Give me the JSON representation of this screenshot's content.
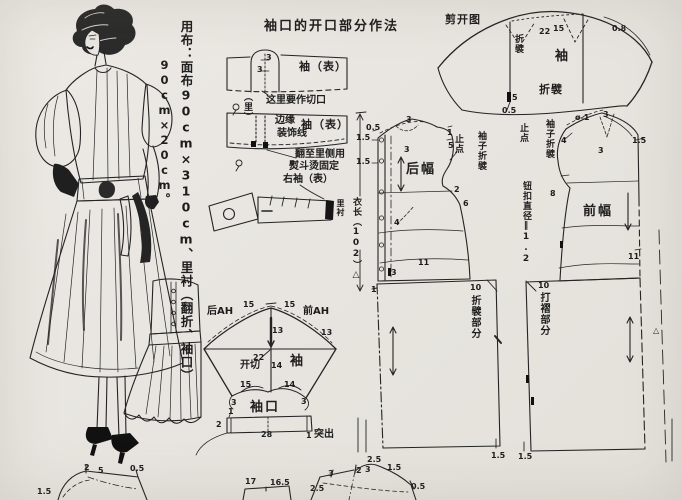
{
  "colors": {
    "paper": "#e9e6e1",
    "ink": "#242424"
  },
  "fabric_note": {
    "column1": "用布：面布90cm×310cm、里衬（翻折、袖口）",
    "column2": "90cm×20cm。"
  },
  "sections": {
    "cuff_howto": [
      {
        "id": "howto-title",
        "text": "袖口的开口部分作法",
        "x": 264,
        "y": 20,
        "cls": "t"
      },
      {
        "id": "slit-3-upper",
        "text": "3",
        "x": 266,
        "y": 54,
        "cls": "s"
      },
      {
        "id": "slit-3-lower",
        "text": "3",
        "x": 257,
        "y": 66,
        "cls": "s"
      },
      {
        "id": "sleeve-outer-label-1",
        "text": "袖（表）",
        "x": 299,
        "y": 61,
        "cls": "b"
      },
      {
        "id": "cut-here-note",
        "text": "这里要作切口",
        "x": 266,
        "y": 96,
        "cls": "m"
      },
      {
        "id": "lining-label-1",
        "text": "（里）",
        "x": 242,
        "y": 92,
        "cls": "s2 v"
      },
      {
        "id": "edge-note-1",
        "text": "边缘",
        "x": 275,
        "y": 116,
        "cls": "m"
      },
      {
        "id": "edge-note-2",
        "text": "装饰线",
        "x": 277,
        "y": 129,
        "cls": "m"
      },
      {
        "id": "sleeve-outer-label-2",
        "text": "袖（表）",
        "x": 301,
        "y": 119,
        "cls": "b"
      },
      {
        "id": "iron-note-1",
        "text": "翻至里侧用",
        "x": 295,
        "y": 150,
        "cls": "m"
      },
      {
        "id": "iron-note-2",
        "text": "熨斗烫固定",
        "x": 289,
        "y": 162,
        "cls": "m"
      },
      {
        "id": "right-sleeve-label",
        "text": "右袖（表）",
        "x": 283,
        "y": 175,
        "cls": "m"
      },
      {
        "id": "lining-label-2",
        "text": "里衬",
        "x": 336,
        "y": 199,
        "cls": "s v"
      }
    ],
    "garment_length": [
      {
        "id": "garment-length-label",
        "text": "衣长（102）△",
        "x": 351,
        "y": 197,
        "cls": "s2 v"
      }
    ],
    "sleeve_draft": [
      {
        "id": "back-ah-label",
        "text": "后AH",
        "x": 207,
        "y": 307,
        "cls": "m"
      },
      {
        "id": "sleeve-15-left",
        "text": "15",
        "x": 243,
        "y": 301,
        "cls": "s"
      },
      {
        "id": "sleeve-15-right",
        "text": "15",
        "x": 284,
        "y": 301,
        "cls": "s"
      },
      {
        "id": "front-ah-label",
        "text": "前AH",
        "x": 303,
        "y": 307,
        "cls": "m"
      },
      {
        "id": "sleeve-13-center",
        "text": "13",
        "x": 272,
        "y": 327,
        "cls": "s"
      },
      {
        "id": "sleeve-13-right",
        "text": "13",
        "x": 321,
        "y": 329,
        "cls": "s"
      },
      {
        "id": "sleeve-22",
        "text": "22",
        "x": 253,
        "y": 354,
        "cls": "s"
      },
      {
        "id": "cut-open-label",
        "text": "开切",
        "x": 240,
        "y": 361,
        "cls": "m"
      },
      {
        "id": "sleeve-14-center",
        "text": "14",
        "x": 271,
        "y": 362,
        "cls": "s"
      },
      {
        "id": "sleeve-label",
        "text": "袖",
        "x": 290,
        "y": 355,
        "cls": "t"
      },
      {
        "id": "sleeve-15-bottom",
        "text": "15",
        "x": 240,
        "y": 381,
        "cls": "s"
      },
      {
        "id": "sleeve-14-bottom",
        "text": "14",
        "x": 284,
        "y": 381,
        "cls": "s"
      },
      {
        "id": "sleeve-3-left",
        "text": "3",
        "x": 231,
        "y": 399,
        "cls": "s"
      },
      {
        "id": "sleeve-3-right",
        "text": "3",
        "x": 301,
        "y": 398,
        "cls": "s"
      },
      {
        "id": "cuff-label",
        "text": "袖口",
        "x": 250,
        "y": 401,
        "cls": "t"
      },
      {
        "id": "cuff-1-left",
        "text": "1",
        "x": 228,
        "y": 408,
        "cls": "s"
      },
      {
        "id": "cuff-2",
        "text": "2",
        "x": 216,
        "y": 421,
        "cls": "s"
      },
      {
        "id": "cuff-28",
        "text": "28",
        "x": 261,
        "y": 431,
        "cls": "s"
      },
      {
        "id": "cuff-1-right",
        "text": "1",
        "x": 306,
        "y": 432,
        "cls": "s"
      },
      {
        "id": "protrude-label",
        "text": "突出",
        "x": 314,
        "y": 430,
        "cls": "m"
      }
    ],
    "spread_diagram": [
      {
        "id": "spread-title",
        "text": "剪开图",
        "x": 445,
        "y": 14,
        "cls": "b"
      },
      {
        "id": "spread-fold-top",
        "text": "折襞",
        "x": 513,
        "y": 34,
        "cls": "s2 v"
      },
      {
        "id": "spread-22",
        "text": "22",
        "x": 539,
        "y": 28,
        "cls": "s"
      },
      {
        "id": "spread-15",
        "text": "15",
        "x": 553,
        "y": 25,
        "cls": "s"
      },
      {
        "id": "spread-08",
        "text": "0.8",
        "x": 612,
        "y": 25,
        "cls": "s"
      },
      {
        "id": "spread-sleeve-label",
        "text": "袖",
        "x": 555,
        "y": 50,
        "cls": "t"
      },
      {
        "id": "spread-fold-bottom",
        "text": "折襞",
        "x": 539,
        "y": 84,
        "cls": "b"
      },
      {
        "id": "spread-5",
        "text": "5",
        "x": 512,
        "y": 94,
        "cls": "s"
      },
      {
        "id": "spread-05",
        "text": "0.5",
        "x": 502,
        "y": 107,
        "cls": "s"
      }
    ],
    "back_panel": [
      {
        "id": "bp-05",
        "text": "0.5",
        "x": 366,
        "y": 124,
        "cls": "s"
      },
      {
        "id": "bp-15-upper",
        "text": "1.5",
        "x": 356,
        "y": 134,
        "cls": "s"
      },
      {
        "id": "bp-15-lower",
        "text": "1.5",
        "x": 356,
        "y": 158,
        "cls": "s"
      },
      {
        "id": "bp-3-shoulder",
        "text": "3",
        "x": 406,
        "y": 116,
        "cls": "s"
      },
      {
        "id": "bp-3-inner",
        "text": "3",
        "x": 404,
        "y": 146,
        "cls": "s"
      },
      {
        "id": "bp-1-neck",
        "text": "1",
        "x": 447,
        "y": 129,
        "cls": "s"
      },
      {
        "id": "bp-5-neck",
        "text": "5",
        "x": 448,
        "y": 142,
        "cls": "s"
      },
      {
        "id": "back-panel-label",
        "text": "后幅",
        "x": 406,
        "y": 163,
        "cls": "t"
      },
      {
        "id": "bp-stop-point",
        "text": "止点",
        "x": 453,
        "y": 134,
        "cls": "s2 v"
      },
      {
        "id": "bp-sleeve-pleat",
        "text": "袖子折襞",
        "x": 476,
        "y": 131,
        "cls": "s2 v"
      },
      {
        "id": "bp-2",
        "text": "2",
        "x": 454,
        "y": 186,
        "cls": "s"
      },
      {
        "id": "bp-6",
        "text": "6",
        "x": 463,
        "y": 200,
        "cls": "s"
      },
      {
        "id": "bp-4",
        "text": "4",
        "x": 394,
        "y": 219,
        "cls": "s"
      },
      {
        "id": "bp-11",
        "text": "11",
        "x": 418,
        "y": 259,
        "cls": "s"
      },
      {
        "id": "bp-3-waist",
        "text": "3",
        "x": 391,
        "y": 269,
        "cls": "s"
      }
    ],
    "front_panel": [
      {
        "id": "fp-stop-point",
        "text": "止点",
        "x": 518,
        "y": 123,
        "cls": "s2 v"
      },
      {
        "id": "fp-sleeve-pleat",
        "text": "袖子折襞",
        "x": 544,
        "y": 119,
        "cls": "s2 v"
      },
      {
        "id": "fp-button-diameter",
        "text": "钮扣直径‖1.2",
        "x": 521,
        "y": 181,
        "cls": "s2 v"
      },
      {
        "id": "fp-d1",
        "text": "ø-1",
        "x": 575,
        "y": 114,
        "cls": "s"
      },
      {
        "id": "fp-3-top",
        "text": "3",
        "x": 603,
        "y": 111,
        "cls": "s"
      },
      {
        "id": "fp-4",
        "text": "4",
        "x": 561,
        "y": 137,
        "cls": "s"
      },
      {
        "id": "fp-3-neck",
        "text": "3",
        "x": 598,
        "y": 147,
        "cls": "s"
      },
      {
        "id": "fp-15",
        "text": "1.5",
        "x": 632,
        "y": 137,
        "cls": "s"
      },
      {
        "id": "fp-8",
        "text": "8",
        "x": 550,
        "y": 190,
        "cls": "s"
      },
      {
        "id": "front-panel-label",
        "text": "前幅",
        "x": 583,
        "y": 205,
        "cls": "t"
      },
      {
        "id": "fp-11",
        "text": "11",
        "x": 628,
        "y": 253,
        "cls": "s"
      }
    ],
    "skirts": [
      {
        "id": "skirt-left-1",
        "text": "1",
        "x": 371,
        "y": 286,
        "cls": "s"
      },
      {
        "id": "skirt-left-10",
        "text": "10",
        "x": 470,
        "y": 284,
        "cls": "s"
      },
      {
        "id": "skirt-left-pleat-part",
        "text": "折襞部分",
        "x": 469,
        "y": 295,
        "cls": "m v"
      },
      {
        "id": "skirt-left-15",
        "text": "1.5",
        "x": 491,
        "y": 452,
        "cls": "s"
      },
      {
        "id": "skirt-right-10",
        "text": "10",
        "x": 538,
        "y": 282,
        "cls": "s"
      },
      {
        "id": "skirt-right-gather-part",
        "text": "打褶部分",
        "x": 538,
        "y": 292,
        "cls": "m v"
      },
      {
        "id": "skirt-right-15",
        "text": "1.5",
        "x": 518,
        "y": 453,
        "cls": "s"
      },
      {
        "id": "fold-triangle-mark",
        "text": "△",
        "x": 653,
        "y": 327,
        "cls": "s"
      }
    ],
    "bottom_pieces": [
      {
        "id": "facing-15",
        "text": "1.5",
        "x": 37,
        "y": 488,
        "cls": "s"
      },
      {
        "id": "facing-2",
        "text": "2",
        "x": 84,
        "y": 464,
        "cls": "s"
      },
      {
        "id": "facing-5",
        "text": "5",
        "x": 98,
        "y": 467,
        "cls": "s"
      },
      {
        "id": "facing-05",
        "text": "0.5",
        "x": 130,
        "y": 465,
        "cls": "s"
      },
      {
        "id": "band-17",
        "text": "17",
        "x": 245,
        "y": 478,
        "cls": "s"
      },
      {
        "id": "band-165",
        "text": "16.5",
        "x": 270,
        "y": 479,
        "cls": "s"
      },
      {
        "id": "collar-3a",
        "text": "3",
        "x": 328,
        "y": 470,
        "cls": "s"
      },
      {
        "id": "collar-2",
        "text": "2",
        "x": 356,
        "y": 467,
        "cls": "s"
      },
      {
        "id": "collar-3b",
        "text": "3",
        "x": 365,
        "y": 466,
        "cls": "s"
      },
      {
        "id": "collar-25-top",
        "text": "2.5",
        "x": 367,
        "y": 456,
        "cls": "s"
      },
      {
        "id": "collar-15",
        "text": "1.5",
        "x": 387,
        "y": 464,
        "cls": "s"
      },
      {
        "id": "collar-25-left",
        "text": "2.5",
        "x": 310,
        "y": 485,
        "cls": "s"
      },
      {
        "id": "collar-05",
        "text": "0.5",
        "x": 411,
        "y": 483,
        "cls": "s"
      }
    ]
  }
}
